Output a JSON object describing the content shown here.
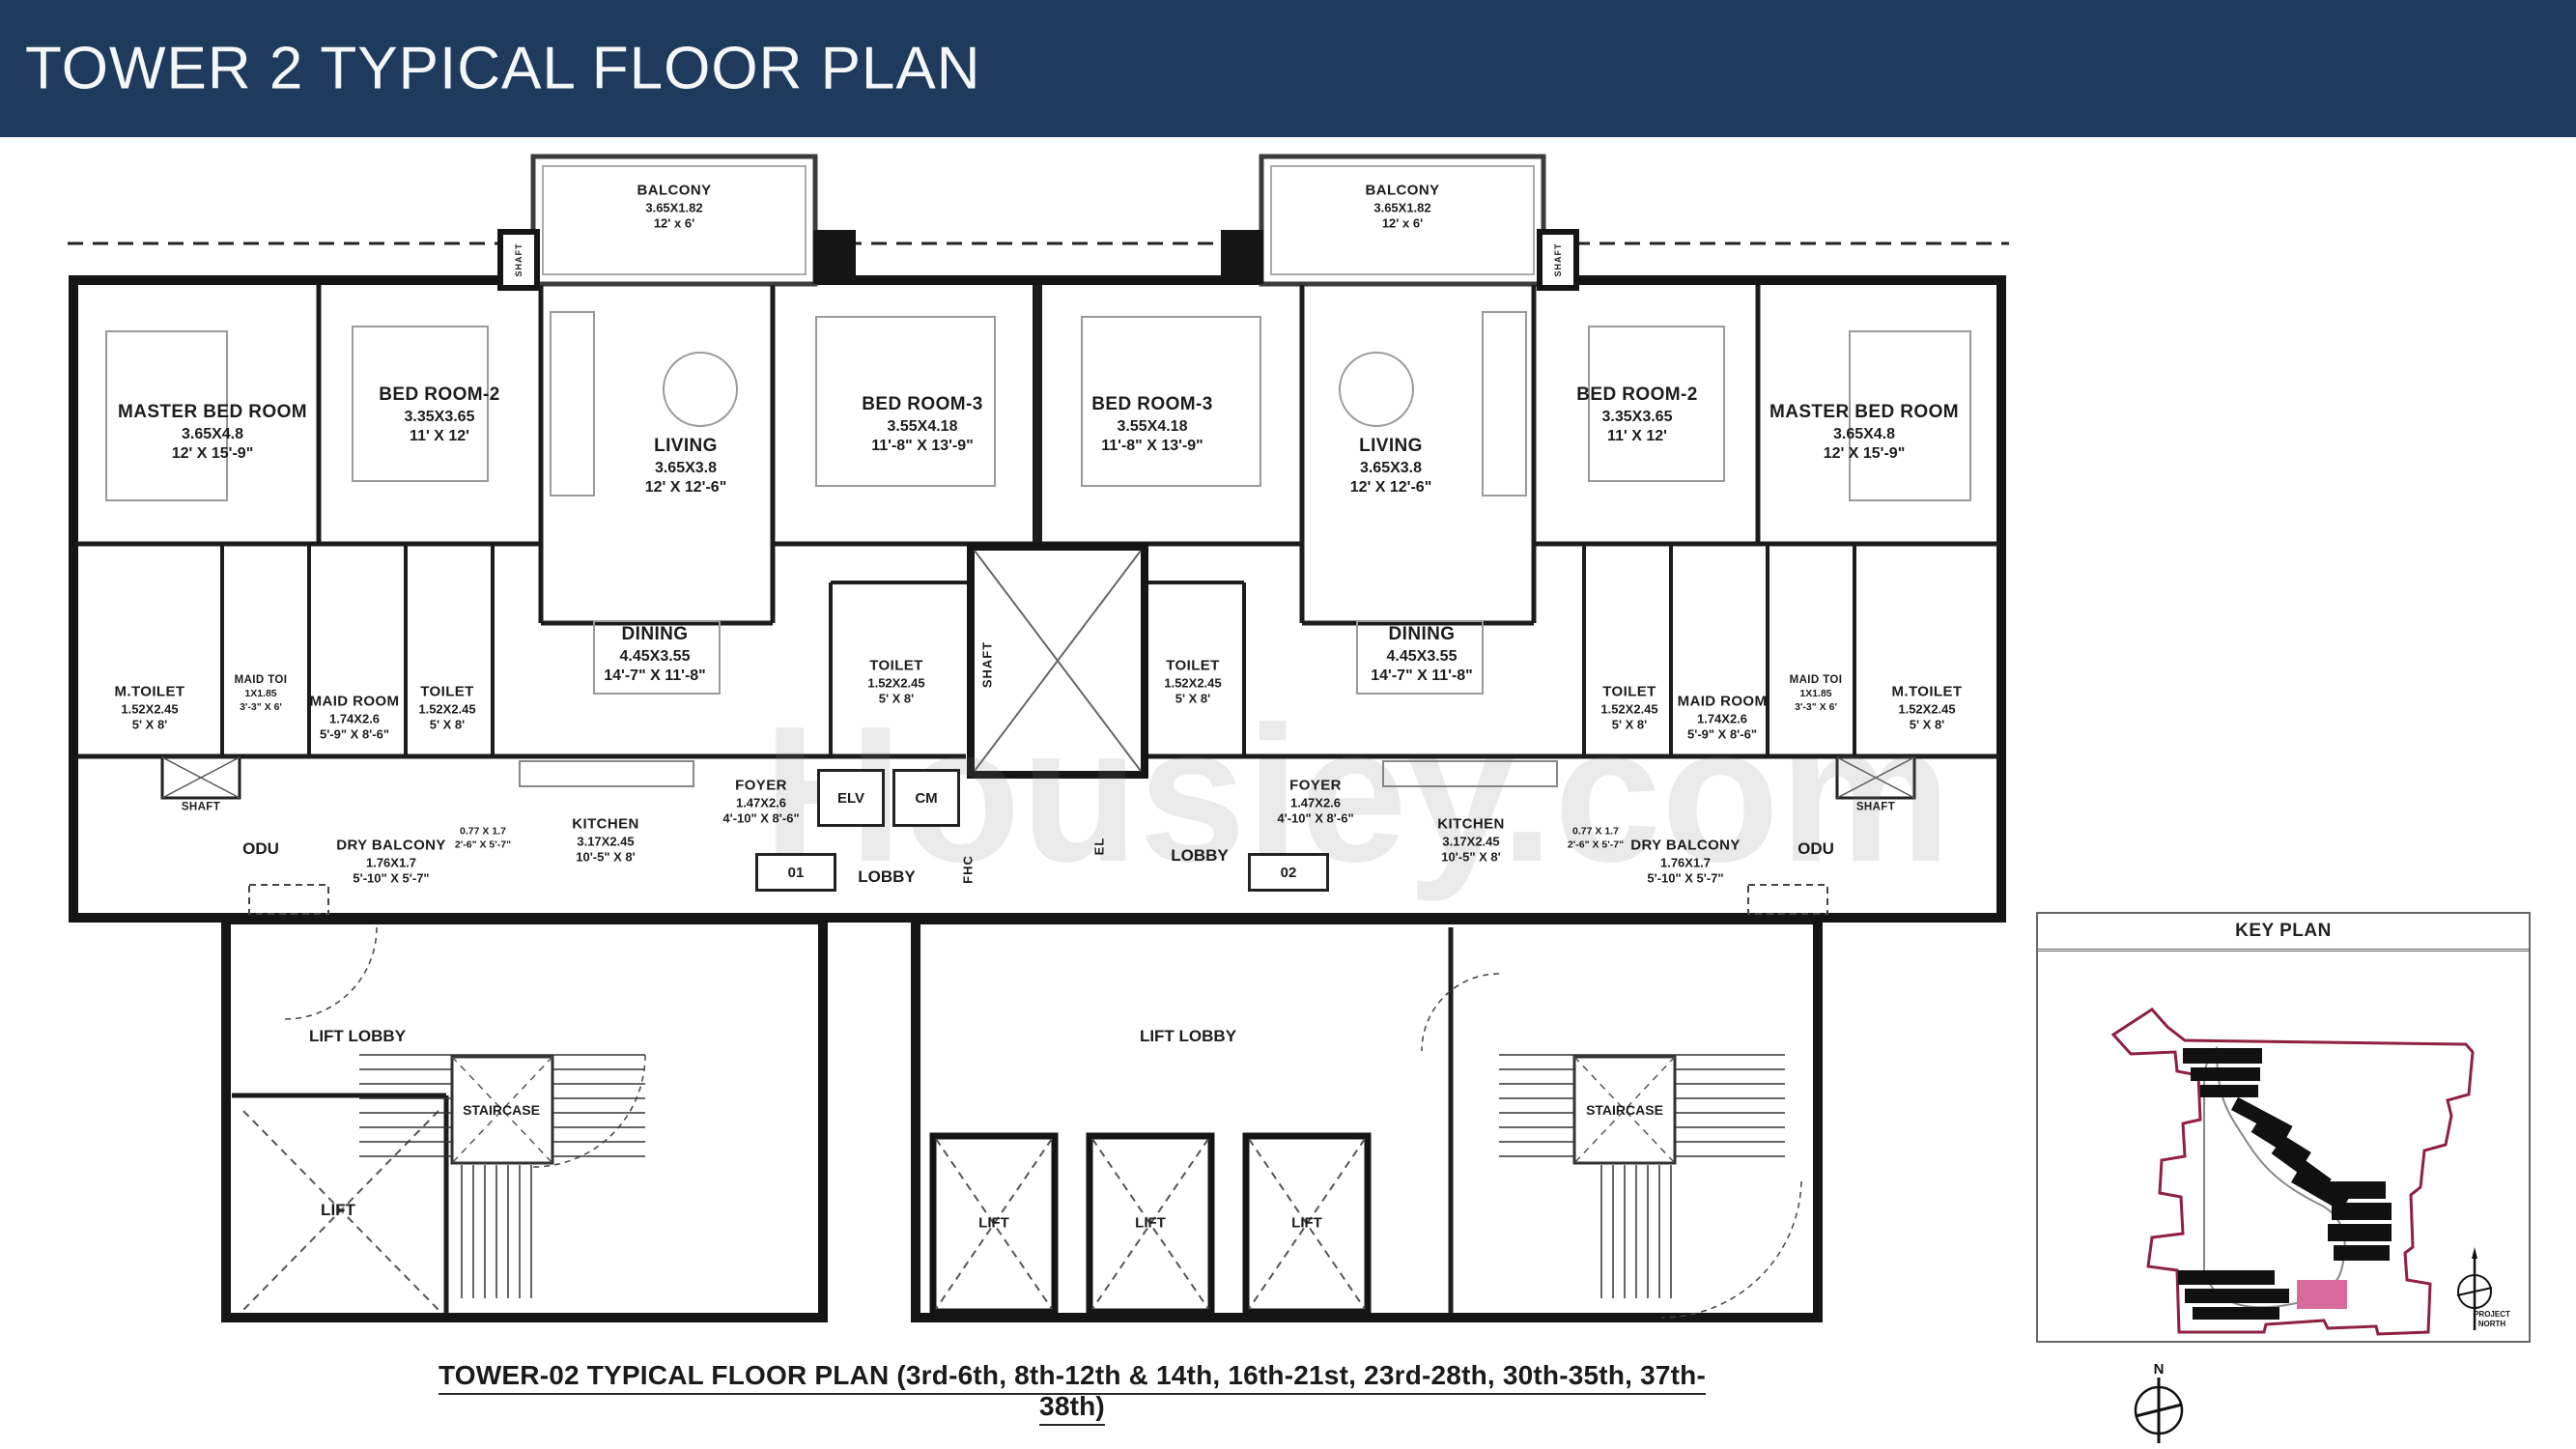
{
  "header": {
    "title": "TOWER 2 TYPICAL FLOOR PLAN"
  },
  "caption": "TOWER-02 TYPICAL FLOOR PLAN (3rd-6th, 8th-12th & 14th, 16th-21st, 23rd-28th, 30th-35th, 37th-38th)",
  "watermark": "Housiey.com",
  "colors": {
    "header_bg": "#1e3a5c",
    "wall": "#151515",
    "site_boundary": "#8e2040",
    "site_highlight": "#d8699b"
  },
  "rooms": {
    "balcony": {
      "name": "BALCONY",
      "metric": "3.65X1.82",
      "imperial": "12' x 6'"
    },
    "master": {
      "name": "MASTER BED ROOM",
      "metric": "3.65X4.8",
      "imperial": "12' X 15'-9\""
    },
    "bedroom2": {
      "name": "BED ROOM-2",
      "metric": "3.35X3.65",
      "imperial": "11' X 12'"
    },
    "living": {
      "name": "LIVING",
      "metric": "3.65X3.8",
      "imperial": "12' X 12'-6\""
    },
    "bedroom3": {
      "name": "BED ROOM-3",
      "metric": "3.55X4.18",
      "imperial": "11'-8\" X 13'-9\""
    },
    "dining": {
      "name": "DINING",
      "metric": "4.45X3.55",
      "imperial": "14'-7\" X 11'-8\""
    },
    "m_toilet": {
      "name": "M.TOILET",
      "metric": "1.52X2.45",
      "imperial": "5' X 8'"
    },
    "maid_toilet": {
      "name": "MAID TOI",
      "metric": "1X1.85",
      "imperial": "3'-3\" X 6'"
    },
    "maid_room": {
      "name": "MAID ROOM",
      "metric": "1.74X2.6",
      "imperial": "5'-9\" X 8'-6\""
    },
    "toilet": {
      "name": "TOILET",
      "metric": "1.52X2.45",
      "imperial": "5' X 8'"
    },
    "foyer": {
      "name": "FOYER",
      "metric": "1.47X2.6",
      "imperial": "4'-10\" X 8'-6\""
    },
    "kitchen": {
      "name": "KITCHEN",
      "metric": "3.17X2.45",
      "imperial": "10'-5\" X 8'"
    },
    "dry_balcony": {
      "name": "DRY BALCONY",
      "metric": "1.76X1.7",
      "imperial": "5'-10\" X 5'-7\""
    },
    "passage": {
      "metric": "0.77 X 1.7",
      "imperial": "2'-6\" X 5'-7\""
    },
    "odu": {
      "name": "ODU"
    },
    "lift_lobby": {
      "name": "LIFT LOBBY"
    },
    "staircase": {
      "name": "STAIRCASE"
    },
    "lift": {
      "name": "LIFT"
    },
    "lobby": {
      "name": "LOBBY"
    },
    "shaft": {
      "name": "SHAFT"
    },
    "elv": {
      "name": "ELV"
    },
    "cm": {
      "name": "CM"
    },
    "fhc": {
      "name": "FHC"
    },
    "el": {
      "name": "EL"
    },
    "unit_01": {
      "name": "01"
    },
    "unit_02": {
      "name": "02"
    }
  },
  "key_plan": {
    "title": "KEY PLAN",
    "north_label_1": "PROJECT",
    "north_label_2": "NORTH"
  },
  "compass": {
    "north": "N"
  }
}
